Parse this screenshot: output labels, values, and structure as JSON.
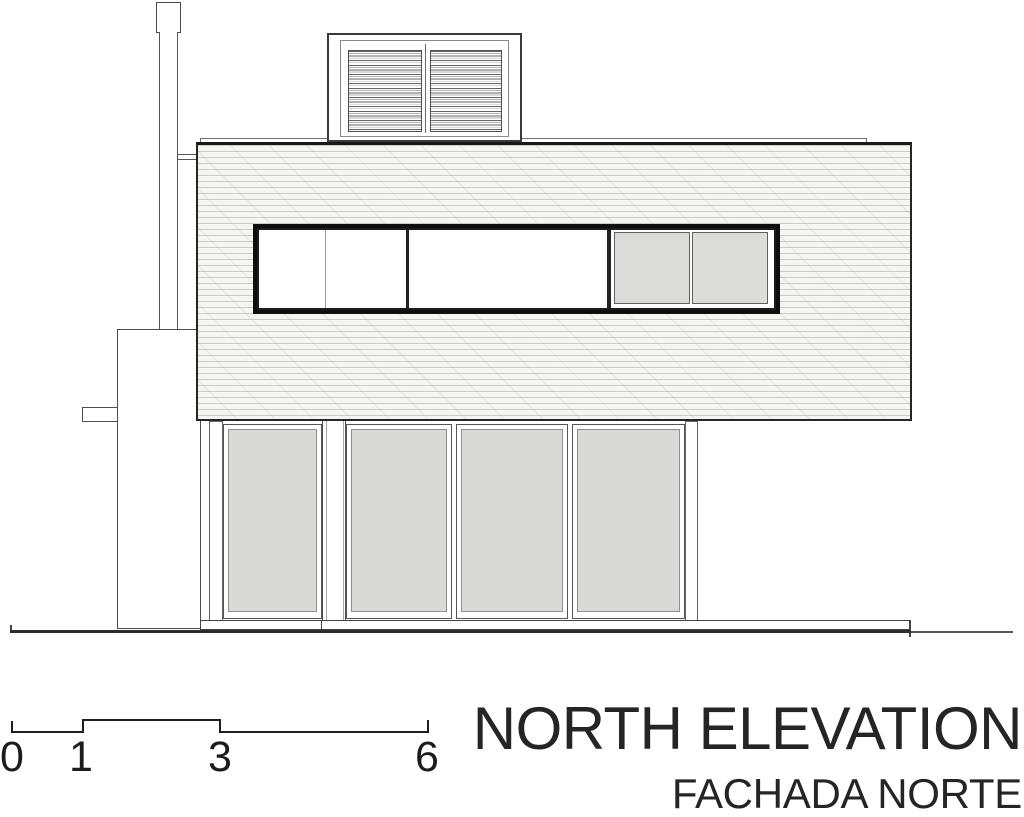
{
  "document": {
    "title": "NORTH ELEVATION",
    "subtitle": "FACHADA NORTE"
  },
  "scale_bar": {
    "labels": [
      "0",
      "1",
      "3",
      "6"
    ]
  },
  "colors": {
    "line": "#2a2a2a",
    "wall_fill": "#f5f5f3",
    "glass_gray": "#d9dad8",
    "window_gray": "#dcddda",
    "frame_black": "#0f0f0f",
    "text": "#272427",
    "background": "#ffffff"
  }
}
